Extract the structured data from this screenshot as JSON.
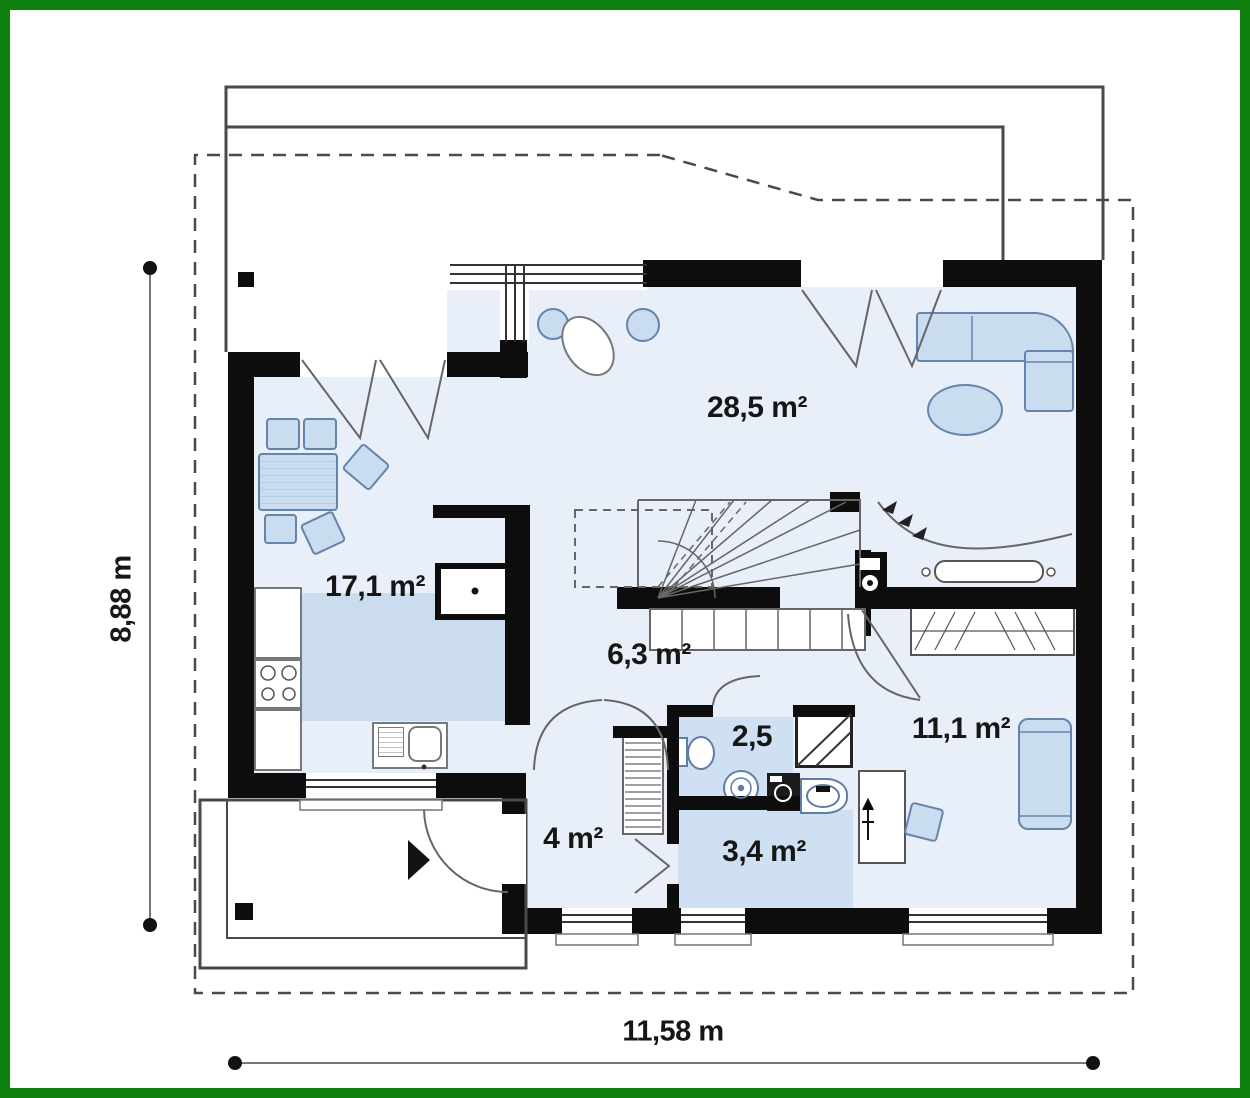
{
  "plan_type": "house-ground-floor-plan",
  "palette": {
    "frame_green": "#0e800e",
    "wall_black": "#0d0d0d",
    "floor_light": "#e9eff8",
    "floor_medium": "#cfe0f3",
    "counter_blue": "#ccdcef",
    "furniture_fill": "#c9dcf0",
    "furniture_stroke": "#6584ab",
    "line_gray": "#4a4a4a"
  },
  "rooms": [
    {
      "id": "living-room",
      "area_label": "28,5 m²"
    },
    {
      "id": "kitchen-dining",
      "area_label": "17,1 m²"
    },
    {
      "id": "hall",
      "area_label": "6,3 m²"
    },
    {
      "id": "wc",
      "area_label": "2,5"
    },
    {
      "id": "bedroom",
      "area_label": "11,1 m²"
    },
    {
      "id": "entry-hall",
      "area_label": "4 m²"
    },
    {
      "id": "bathroom",
      "area_label": "3,4 m²"
    }
  ],
  "dimensions": {
    "overall_width_label": "11,58 m",
    "overall_depth_label": "8,88 m"
  }
}
